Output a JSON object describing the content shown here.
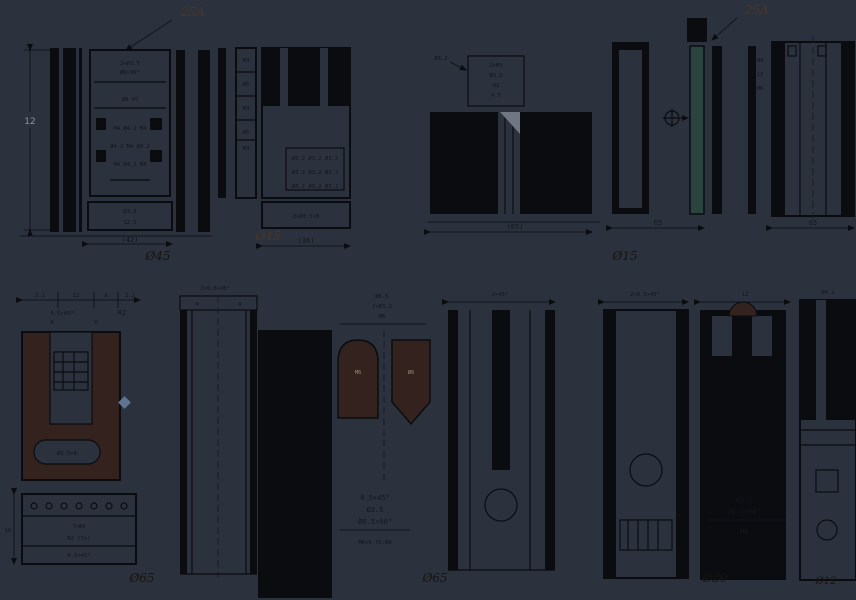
{
  "sheet": {
    "kind": "mechanical-part-drawing",
    "rows": 2,
    "view_groups": 9
  },
  "colors": {
    "background": "#2c323d",
    "ink": "#0a0c10",
    "teal_fill": "#2b443f",
    "brown_fill": "#33221d",
    "brown_note": "#4a3626",
    "gray_dim": "#8b93a0",
    "blue_marker": "#5f7590",
    "wedge_gray": "#707682"
  },
  "t": {
    "g1_note": "25A",
    "g1_h": "12",
    "g1_m1": "2×Ø3.5",
    "g1_m2": "Ø6×90°",
    "g1_m3": "Ø8 H7",
    "g1_g1": "M4 Ø4.2 M4",
    "g1_g2": "Ø4.2 M4 Ø4.2",
    "g1_g3": "M4 Ø4.2 M4",
    "g1_b1": "Ø3.5",
    "g1_b2": "12.5",
    "g1_w": "(42)",
    "g1_dia": "Ø45",
    "g2_s1": "M3",
    "g2_s2": "Ø5",
    "g2_s3": "M3",
    "g2_s4": "Ø5",
    "g2_s5": "M3",
    "g2_r1": "Ø3.2 Ø3.2 Ø3.2",
    "g2_r2": "Ø3.2 Ø3.2 Ø3.2",
    "g2_r3": "Ø3.2 Ø3.2 Ø3.2",
    "g2_b1": "2×Ø3.5×8",
    "g2_w": "(36)",
    "g2_dia": "Ø45",
    "g3_a": "Ø3.2",
    "g3_m1": "2×M3",
    "g3_m2": "Ø3.5",
    "g3_m3": "R2",
    "g3_m4": "4.5",
    "g3_w": "(65)",
    "g3_dia": "Ø15",
    "g4_note": "25A",
    "g4_s1": "Ø4",
    "g4_s2": "12",
    "g4_s3": "Ø6",
    "g4_w1": "65",
    "g4_w2": "65",
    "g5_c1": "3.2",
    "g5_c2": "12",
    "g5_c3": "8",
    "g5_c4": "3.2",
    "g5_c5": "0.5×45°",
    "g5_r": "R2",
    "g5_x1": "✕",
    "g5_x2": "✕",
    "g5_slot": "Ø3.5×8",
    "g5_p1": "7×Ø4",
    "g5_p2": "R2 (7×)",
    "g5_p3": "0.5×45°",
    "g5_h": "18",
    "g5_dia": "Ø65",
    "g6_t": "2×0.5×45°",
    "g6_x1": "✕",
    "g6_x2": "✕",
    "g7_t1": "Ø6.5",
    "g7_t2": "2×Ø3.2",
    "g7_t3": "M6",
    "g7_a1": "M6",
    "g7_a2": "Ø6",
    "g7_b1": "0.5×45°",
    "g7_b2": "Ø3.5",
    "g7_b3": "Ø6.5×90°",
    "g7_b4": "M6×0.75-6H",
    "g7_dia": "Ø65",
    "g8_t": "2×45°",
    "g9_t1": "2×0.5×45°",
    "g9_t2": "12",
    "g9_s1": "Ø4.2",
    "g9_s2": "M5",
    "g9_s3": "Ø4.2",
    "g9_b1": "Ø3.2",
    "g9_b2": "Ø6.5×90°",
    "g9_b3": "M6",
    "g9_dia": "Ø30",
    "g9_dia2": "Ø12"
  }
}
